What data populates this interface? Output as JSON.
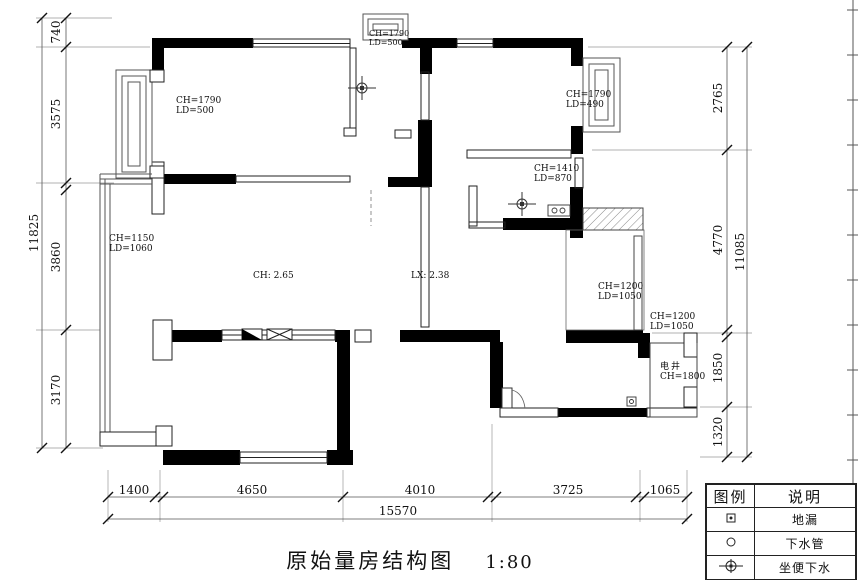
{
  "title": {
    "text": "原始量房结构图",
    "scale": "1:80"
  },
  "dimensions": {
    "left": {
      "segments": [
        "740",
        "3575",
        "3860",
        "3170"
      ],
      "total": "11825"
    },
    "right": {
      "segments": [
        "2765",
        "4770",
        "1850",
        "1320"
      ],
      "total": "11085"
    },
    "bottom": {
      "segments": [
        "1400",
        "4650",
        "4010",
        "3725",
        "1065"
      ],
      "total": "15570"
    }
  },
  "annotations": {
    "bay_top_left": {
      "l1": "CH=1790",
      "l2": "LD=500"
    },
    "bay_top_bump": {
      "l1": "CH=1790",
      "l2": "LD=500"
    },
    "bay_top_right": {
      "l1": "CH=1790",
      "l2": "LD=490"
    },
    "bath2_window": {
      "l1": "CH=1410",
      "l2": "LD=870"
    },
    "bay_left": {
      "l1": "CH=1150",
      "l2": "LD=1060"
    },
    "ceiling_height": "CH: 2.65",
    "beam_height": "LX: 2.38",
    "shaft_window_1": {
      "l1": "CH=1200",
      "l2": "LD=1050"
    },
    "shaft_window_2": {
      "l1": "CH=1200",
      "l2": "LD=1050"
    },
    "electric_shaft": {
      "name": "电井",
      "height": "CH=1800"
    }
  },
  "legend": {
    "headers": {
      "symbol": "图例",
      "description": "说明"
    },
    "rows": [
      {
        "icon": "floor-drain-icon",
        "label": "地漏"
      },
      {
        "icon": "drain-pipe-icon",
        "label": "下水管"
      },
      {
        "icon": "toilet-drain-icon",
        "label": "坐便下水"
      },
      {
        "icon": "electric-box-icon",
        "label": "强电箱"
      }
    ]
  }
}
